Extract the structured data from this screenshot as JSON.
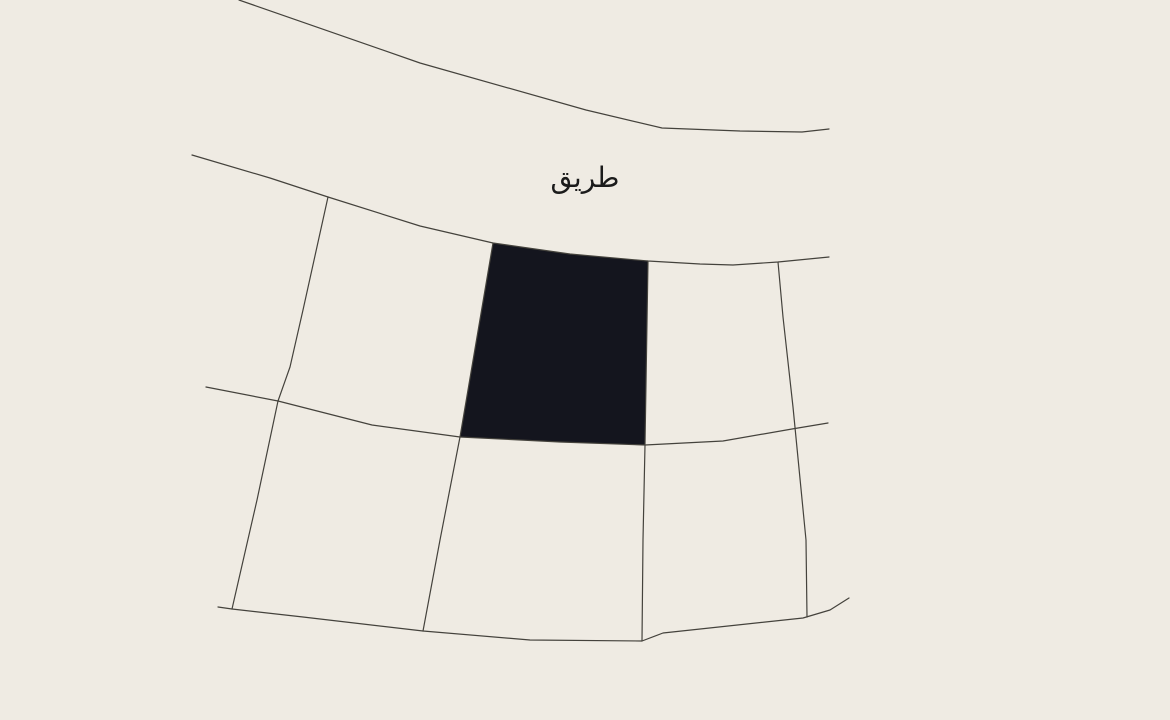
{
  "map": {
    "road_label": "طريق",
    "colors": {
      "background": "#EFEBE3",
      "boundary_line": "#44423C",
      "selected_parcel_fill": "#14151E",
      "label_text": "#1B1B1B"
    },
    "selected_parcel": {
      "points": [
        [
          493,
          243
        ],
        [
          570,
          254
        ],
        [
          648,
          261
        ],
        [
          645,
          445
        ],
        [
          560,
          442
        ],
        [
          460,
          437
        ]
      ]
    },
    "boundary_lines": [
      {
        "name": "road-edge-upper",
        "points": [
          [
            239,
            0
          ],
          [
            420,
            63
          ],
          [
            586,
            110
          ],
          [
            662,
            128
          ],
          [
            740,
            131
          ],
          [
            802,
            132
          ],
          [
            829,
            129
          ]
        ]
      },
      {
        "name": "road-edge-lower",
        "points": [
          [
            192,
            155
          ],
          [
            270,
            178
          ],
          [
            328,
            197
          ],
          [
            420,
            226
          ],
          [
            493,
            243
          ],
          [
            570,
            254
          ],
          [
            648,
            261
          ],
          [
            700,
            264
          ],
          [
            733,
            265
          ],
          [
            778,
            262
          ],
          [
            829,
            257
          ]
        ]
      },
      {
        "name": "parcel-boundary-vertical-1",
        "points": [
          [
            328,
            197
          ],
          [
            303,
            310
          ],
          [
            290,
            367
          ],
          [
            278,
            401
          ],
          [
            257,
            500
          ],
          [
            232,
            609
          ]
        ]
      },
      {
        "name": "parcel-boundary-vertical-2",
        "points": [
          [
            493,
            243
          ],
          [
            460,
            437
          ],
          [
            440,
            540
          ],
          [
            423,
            631
          ]
        ]
      },
      {
        "name": "parcel-boundary-vertical-3",
        "points": [
          [
            648,
            261
          ],
          [
            645,
            445
          ],
          [
            643,
            540
          ],
          [
            642,
            641
          ]
        ]
      },
      {
        "name": "parcel-boundary-vertical-4",
        "points": [
          [
            778,
            262
          ],
          [
            783,
            317
          ],
          [
            793,
            407
          ],
          [
            806,
            540
          ],
          [
            807,
            617
          ]
        ]
      },
      {
        "name": "parcel-boundary-horizontal-mid",
        "points": [
          [
            206,
            387
          ],
          [
            278,
            401
          ],
          [
            372,
            425
          ],
          [
            460,
            437
          ],
          [
            560,
            442
          ],
          [
            645,
            445
          ],
          [
            723,
            441
          ],
          [
            792,
            429
          ],
          [
            828,
            423
          ]
        ]
      },
      {
        "name": "parcel-boundary-horizontal-bottom",
        "points": [
          [
            218,
            607
          ],
          [
            232,
            609
          ],
          [
            303,
            617
          ],
          [
            423,
            631
          ],
          [
            530,
            640
          ],
          [
            642,
            641
          ],
          [
            663,
            633
          ],
          [
            803,
            618
          ],
          [
            830,
            610
          ],
          [
            849,
            598
          ]
        ]
      }
    ]
  }
}
